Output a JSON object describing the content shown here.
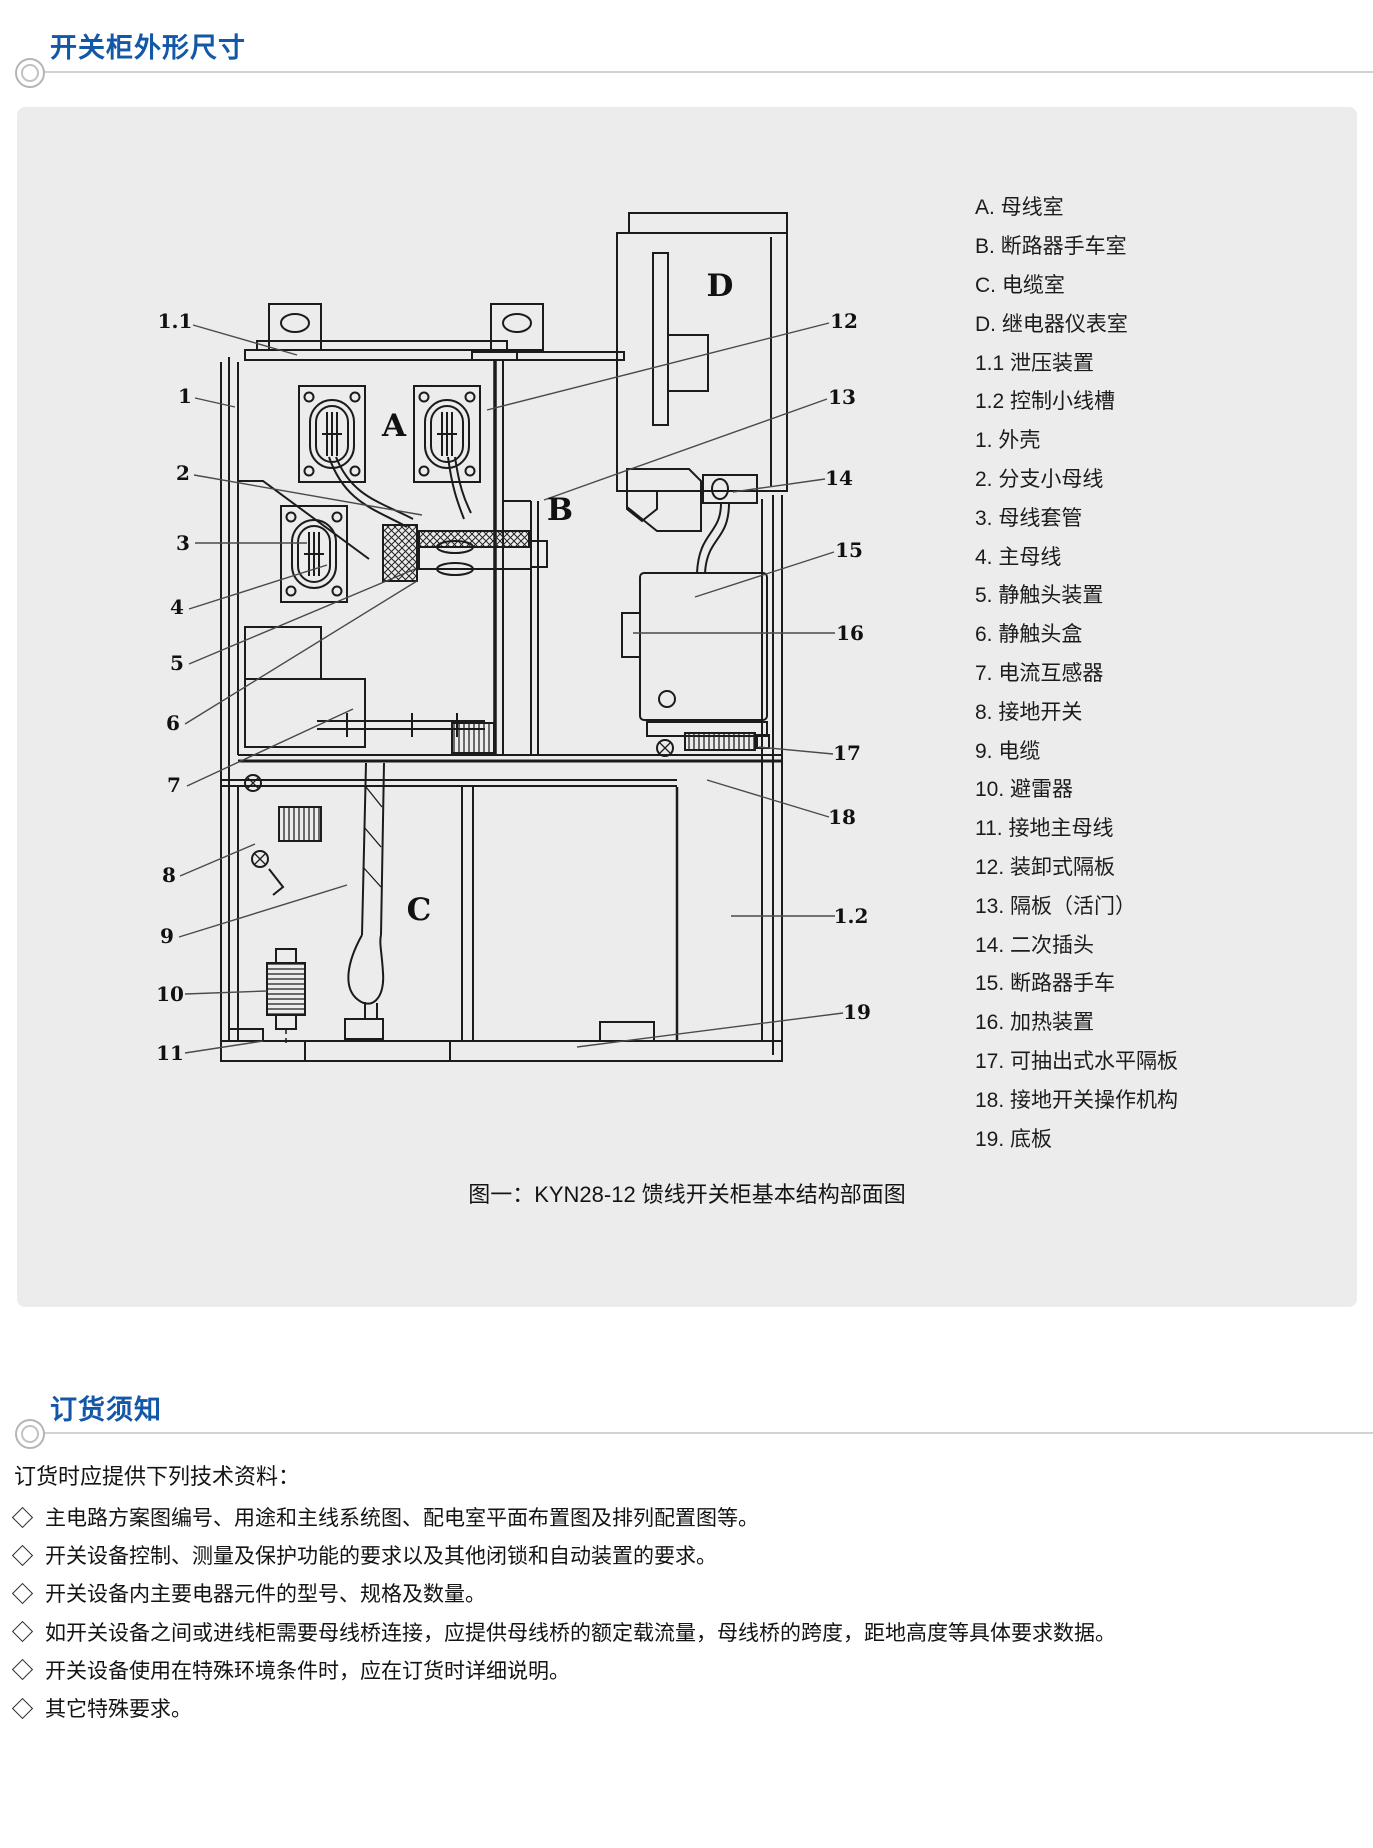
{
  "section_outline": {
    "title": "开关柜外形尺寸"
  },
  "section_ordering": {
    "title": "订货须知"
  },
  "figure": {
    "caption": "图一：KYN28-12 馈线开关柜基本结构部面图",
    "compartments": [
      "A",
      "B",
      "C",
      "D"
    ],
    "left_callouts": [
      "1.1",
      "1",
      "2",
      "3",
      "4",
      "5",
      "6",
      "7",
      "8",
      "9",
      "10",
      "11"
    ],
    "right_callouts": [
      "12",
      "13",
      "14",
      "15",
      "16",
      "17",
      "18",
      "1.2",
      "19"
    ],
    "legend_items": [
      "A. 母线室",
      "B. 断路器手车室",
      "C. 电缆室",
      "D. 继电器仪表室",
      "1.1 泄压装置",
      "1.2 控制小线槽",
      "1. 外壳",
      "2. 分支小母线",
      "3. 母线套管",
      "4. 主母线",
      "5. 静触头装置",
      "6. 静触头盒",
      "7. 电流互感器",
      "8. 接地开关",
      "9. 电缆",
      "10. 避雷器",
      "11. 接地主母线",
      "12. 装卸式隔板",
      "13. 隔板（活门）",
      "14. 二次插头",
      "15. 断路器手车",
      "16. 加热装置",
      "17. 可抽出式水平隔板",
      "18. 接地开关操作机构",
      "19. 底板"
    ]
  },
  "ordering": {
    "intro": "订货时应提供下列技术资料：",
    "items": [
      "主电路方案图编号、用途和主线系统图、配电室平面布置图及排列配置图等。",
      "开关设备控制、测量及保护功能的要求以及其他闭锁和自动装置的要求。",
      "开关设备内主要电器元件的型号、规格及数量。",
      "如开关设备之间或进线柜需要母线桥连接，应提供母线桥的额定载流量，母线桥的跨度，距地高度等具体要求数据。",
      "开关设备使用在特殊环境条件时，应在订货时详细说明。",
      "其它特殊要求。"
    ]
  },
  "colors": {
    "accent_blue": "#1257a8",
    "panel_gray": "#ececec",
    "rule_gray": "#d2d2d2",
    "line_black": "#1b1b1b"
  }
}
